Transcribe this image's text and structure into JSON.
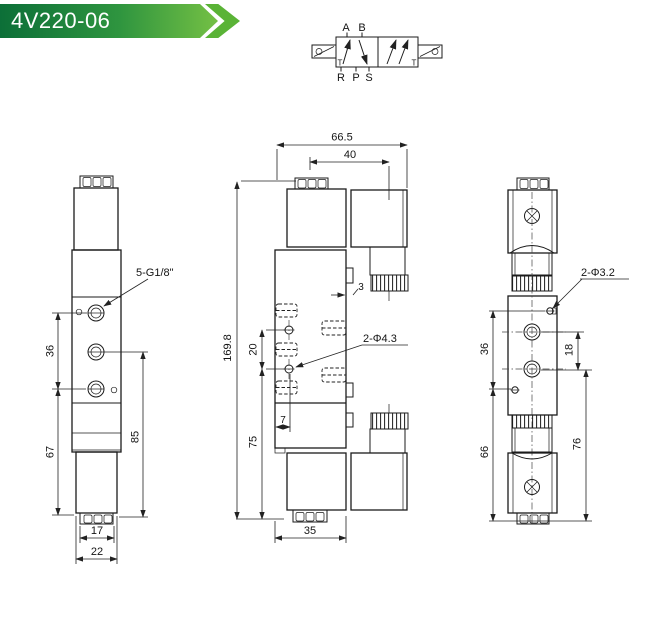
{
  "banner": {
    "title": "4V220-06",
    "color_dark": "#0c6f38",
    "color_light": "#74c044"
  },
  "symbol": {
    "port_a": "A",
    "port_b": "B",
    "port_r": "R",
    "port_p": "P",
    "port_s": "S",
    "t_left": "T",
    "t_right": "T"
  },
  "views": {
    "left": {
      "thread_label": "5-G1/8\"",
      "dim_port_span": "36",
      "dim_body": "67",
      "dim_total": "85",
      "dim_block": "17",
      "dim_width": "22"
    },
    "front": {
      "dim_width_total": "66.5",
      "dim_top": "40",
      "dim_height_total": "169.8",
      "dim_plate": "3",
      "dim_hole_span": "20",
      "dim_lower": "75",
      "dim_edge": "7",
      "dim_bottom_width": "35",
      "holes_label": "2-Φ4.3"
    },
    "right": {
      "holes_label": "2-Φ3.2",
      "dim_hole_span": "36",
      "dim_port_span": "18",
      "dim_lower": "66",
      "dim_total": "76"
    }
  }
}
